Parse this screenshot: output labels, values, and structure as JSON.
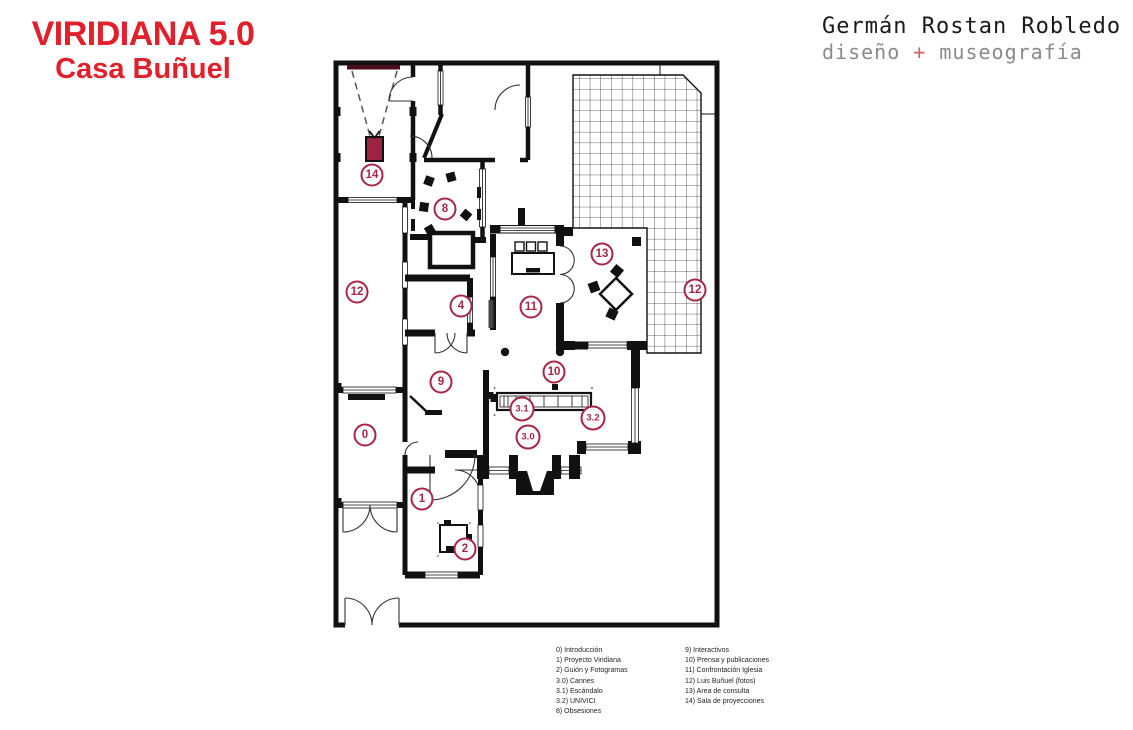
{
  "header": {
    "title_line1": "VIRIDIANA 5.0",
    "title_line2": "Casa Buñuel"
  },
  "credit": {
    "name": "Germán Rostan Robledo",
    "tagline_left": "diseño ",
    "tagline_plus": "+",
    "tagline_right": " museografía"
  },
  "colors": {
    "title_red": "#e0202a",
    "marker_crimson": "#a72645",
    "wall_black": "#111111",
    "credit_gray": "#8a8a8a",
    "plus_red": "#de5a65",
    "projector_fill": "#9e2242",
    "screen_maroon": "#4d0e1c"
  },
  "floor_plan": {
    "markers": [
      {
        "id": "14",
        "x": 39,
        "y": 118
      },
      {
        "id": "8",
        "x": 112,
        "y": 152
      },
      {
        "id": "12",
        "x": 24,
        "y": 235
      },
      {
        "id": "4",
        "x": 128,
        "y": 249
      },
      {
        "id": "11",
        "x": 198,
        "y": 250
      },
      {
        "id": "13",
        "x": 269,
        "y": 197
      },
      {
        "id": "12",
        "x": 362,
        "y": 233
      },
      {
        "id": "9",
        "x": 108,
        "y": 325
      },
      {
        "id": "10",
        "x": 221,
        "y": 315
      },
      {
        "id": "3.1",
        "x": 189,
        "y": 352
      },
      {
        "id": "3.2",
        "x": 260,
        "y": 361
      },
      {
        "id": "3.0",
        "x": 195,
        "y": 380
      },
      {
        "id": "0",
        "x": 32,
        "y": 378
      },
      {
        "id": "1",
        "x": 89,
        "y": 442
      },
      {
        "id": "2",
        "x": 132,
        "y": 492
      }
    ]
  },
  "legend": {
    "column1": [
      "0) Introducción",
      "1) Proyecto Viridiana",
      "2) Guión y Fotogramas",
      "3.0) Cannes",
      "3.1) Escándalo",
      "3.2) UNIVICI",
      "8) Obsesiones"
    ],
    "column2": [
      "9) Interactivos",
      "10) Prensa y publicaciones",
      "11) Confrontación Iglesia",
      "12) Luis Buñuel (fotos)",
      "13) Area de consulta",
      "14) Sala de proyecciones"
    ]
  }
}
